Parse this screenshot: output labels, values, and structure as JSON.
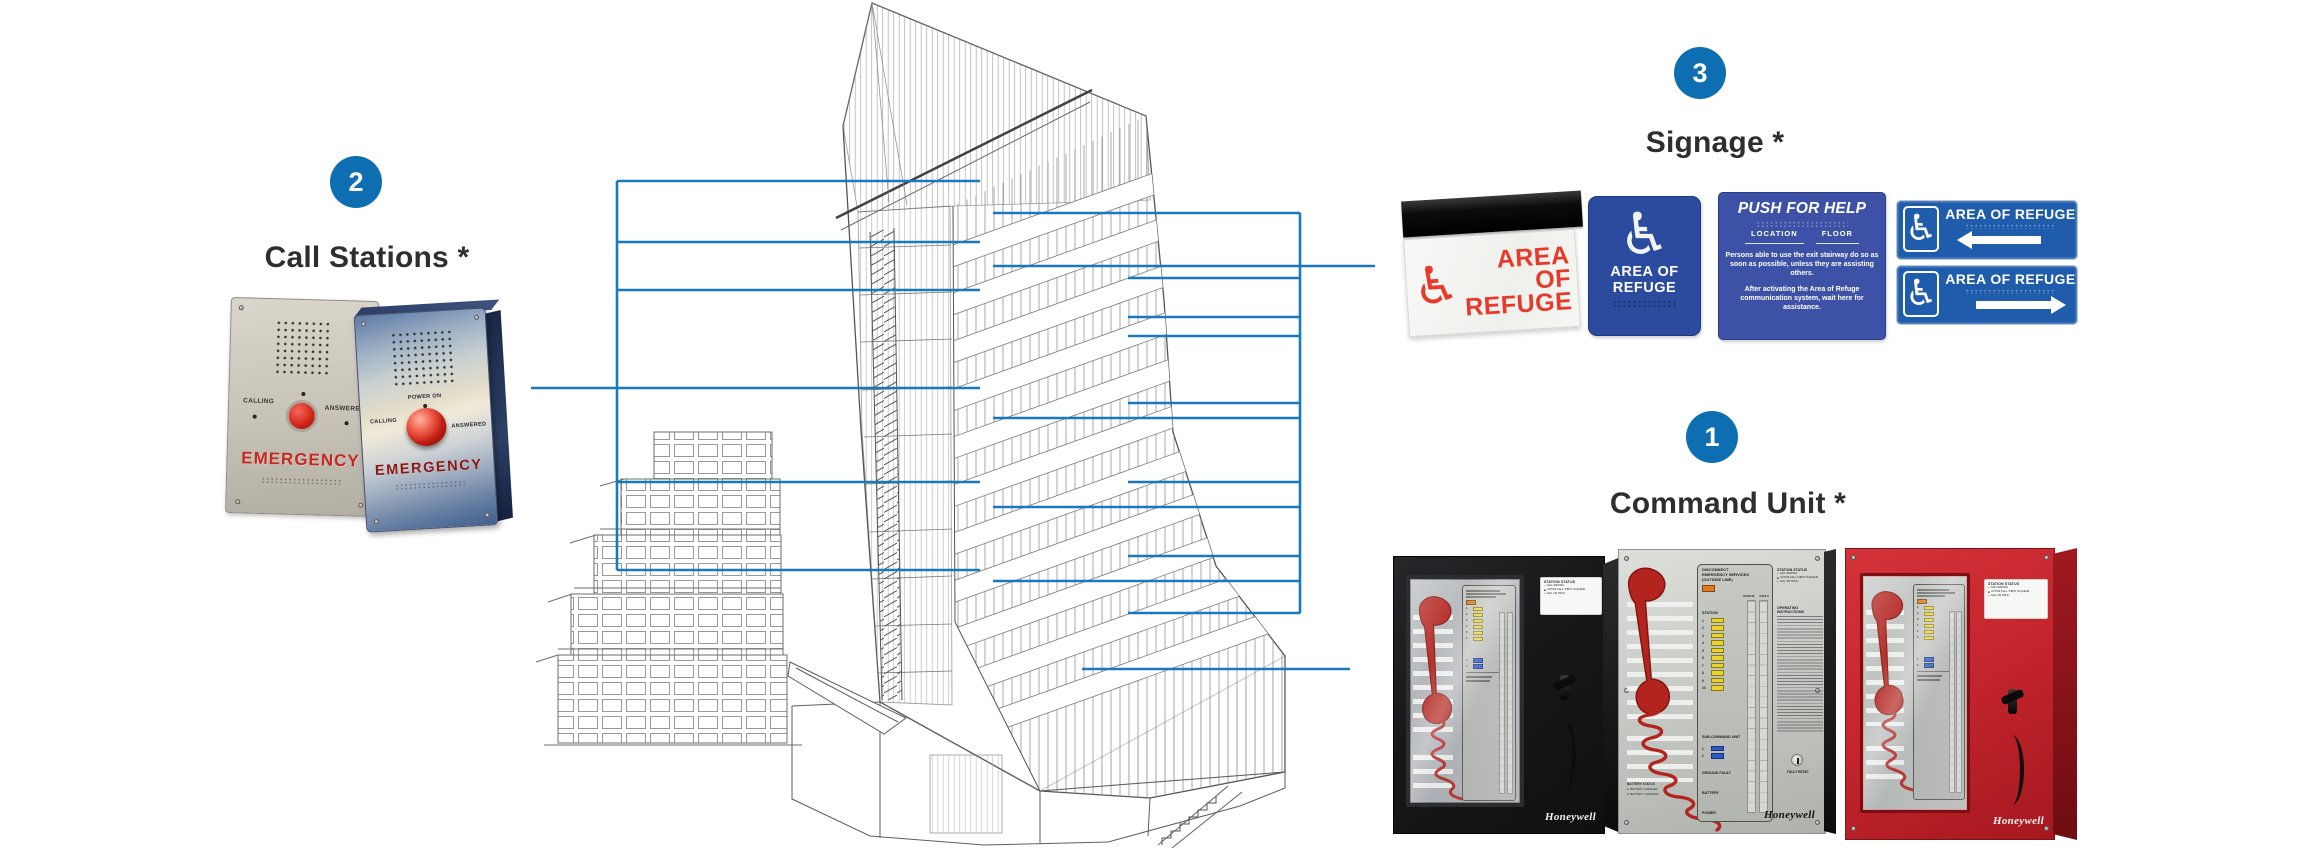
{
  "colors": {
    "accent_blue": "#0d6fb2",
    "leader_line_blue": "#1a78bd",
    "sign_red": "#e8392b",
    "plaque_blue": "#2b4b9e",
    "push_sign_blue": "#3d52a6",
    "directional_blue": "#1f5cab",
    "honeywell_red_cabinet": "#c4242c"
  },
  "callouts": {
    "command_unit": {
      "badge": "1",
      "label": "Command Unit *"
    },
    "call_stations": {
      "badge": "2",
      "label": "Call Stations *"
    },
    "signage": {
      "badge": "3",
      "label": "Signage *"
    }
  },
  "call_stations": {
    "left": {
      "calling": "CALLING",
      "answered": "ANSWERED",
      "emergency": "EMERGENCY"
    },
    "right": {
      "power_on": "POWER ON",
      "calling": "CALLING",
      "answered": "ANSWERED",
      "emergency": "EMERGENCY"
    }
  },
  "signage": {
    "edge_lit": {
      "lines": [
        "AREA",
        "OF",
        "REFUGE"
      ]
    },
    "ada_plaque": {
      "lines": [
        "AREA OF",
        "REFUGE"
      ]
    },
    "push_for_help": {
      "title": "PUSH FOR HELP",
      "location_label": "LOCATION",
      "floor_label": "FLOOR",
      "body1": "Persons able to use the exit stairway do so as soon as possible, unless they are assisting others.",
      "body2": "After activating the Area of Refuge communication system, wait here for assistance."
    },
    "directional_top": {
      "text": "AREA OF REFUGE",
      "arrow": "left"
    },
    "directional_bottom": {
      "text": "AREA OF REFUGE",
      "arrow": "right"
    }
  },
  "command_unit": {
    "brand": "Honeywell",
    "panel": {
      "header_lines": [
        "DISCONNECT",
        "EMERGENCY SERVICES",
        "(OUTSIDE LINE)"
      ],
      "status_label": "STATUS",
      "fault_label": "FAULT",
      "station_label": "STATION",
      "station_numbers": [
        "1",
        "2",
        "3",
        "4",
        "5",
        "6",
        "7",
        "8",
        "9",
        "10"
      ],
      "mini_station_numbers": [
        "1",
        "2",
        "3",
        "4",
        "5",
        "6"
      ],
      "sub_command_label": "SUB-COMMAND UNIT",
      "sub_numbers": [
        "1",
        "2"
      ],
      "ground_fault_label": "GROUND FAULT",
      "battery_label": "BATTERY",
      "power_label": "POWER"
    },
    "station_status": {
      "title": "STATION STATUS",
      "items": [
        "CALL WAITING",
        "ACTIVE CALL / FIRST IN QUEUE",
        "CALL ON HOLD"
      ]
    },
    "operating_instructions_title": "OPERATING INSTRUCTIONS",
    "fault_reset_label": "FAULT RESET",
    "battery_status": {
      "title": "BATTERY STATUS",
      "items": [
        "BATTERY CHARGED",
        "BATTERY CHARGING"
      ]
    }
  }
}
